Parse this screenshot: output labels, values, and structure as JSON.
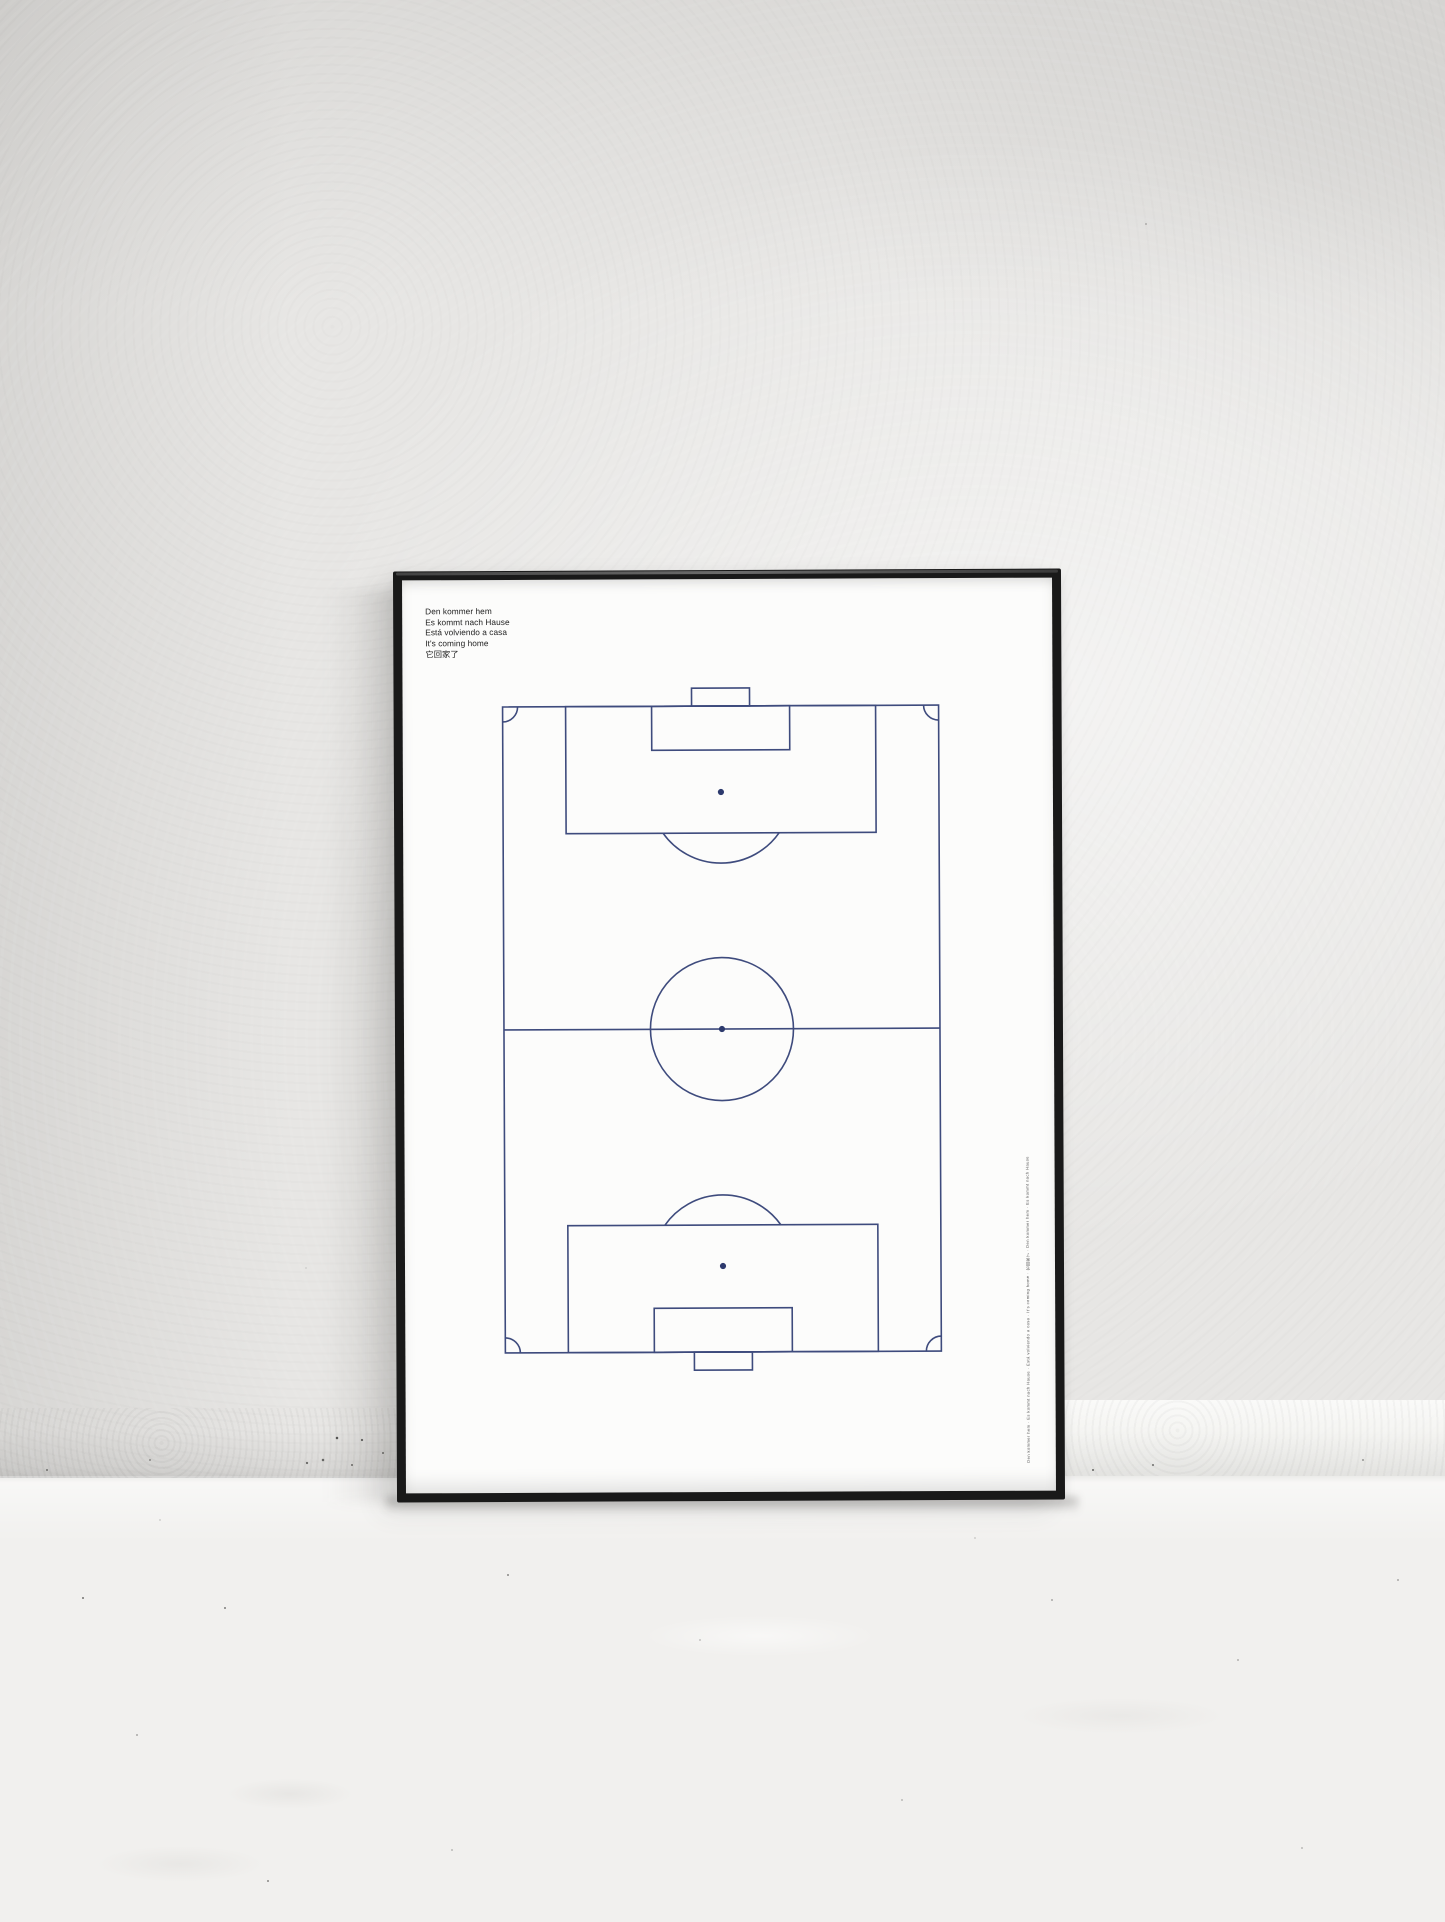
{
  "scene": {
    "description": "Photo-style mockup: black thin-frame poster of a football pitch line drawing, leaning against a white plaster wall on a light concrete floor",
    "colors": {
      "wall": "#e7e6e4",
      "floor": "#f1f0ee",
      "frame": "#191919",
      "paper": "#fcfcfb",
      "pitch_line": "#3e4b7d",
      "pitch_spot": "#2d3a6d",
      "caption_text": "#232323"
    }
  },
  "poster": {
    "caption_lines": [
      "Den kommer hem",
      "Es kommt nach Hause",
      "Está volviendo a casa",
      "It's coming home",
      "它回家了"
    ],
    "microtext": "Den kommer hem · Es kommt nach Hause · Está volviendo a casa · It's coming home · 它回家了 · Den kommer hem · Es kommt nach Hause · Está volviendo a casa · It's coming home · 它回家了"
  },
  "diagram": {
    "type": "association-football-pitch-plan",
    "elements": [
      "pitch-outline",
      "halfway-line",
      "center-circle",
      "center-spot",
      "penalty-area-top",
      "goal-area-top",
      "goal-top",
      "penalty-spot-top",
      "penalty-arc-top",
      "penalty-area-bottom",
      "goal-area-bottom",
      "goal-bottom",
      "penalty-spot-bottom",
      "penalty-arc-bottom",
      "corner-arc-top-left",
      "corner-arc-top-right",
      "corner-arc-bottom-left",
      "corner-arc-bottom-right"
    ]
  }
}
